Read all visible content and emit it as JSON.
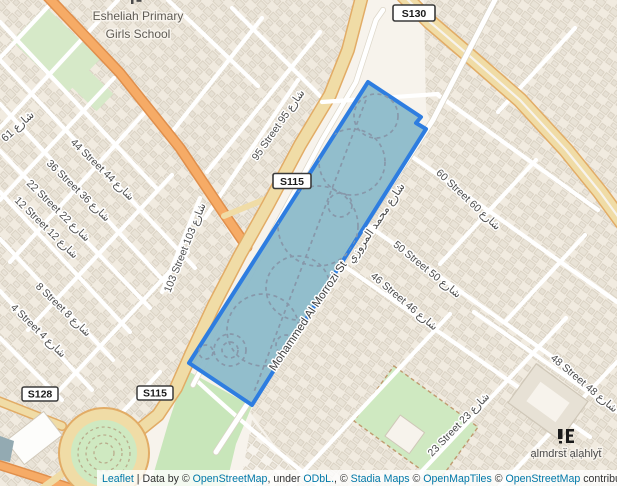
{
  "map": {
    "poi": {
      "school_line1": "Esheliah Primary",
      "school_line2": "Girls School",
      "mosque_school_label": "ạlmdrsẗ ạlạhlyẗ"
    },
    "shields": [
      {
        "text": "S130"
      },
      {
        "text": "S115"
      },
      {
        "text": "S115"
      },
      {
        "text": "S128"
      }
    ],
    "street_labels": [
      {
        "text": "44 Street 44 شارع"
      },
      {
        "text": "36 Street 36 شارع"
      },
      {
        "text": "22 Street 22 شارع"
      },
      {
        "text": "12 Street 12 شارع"
      },
      {
        "text": "8 Street 8 شارع"
      },
      {
        "text": "4 Street 4 شارع"
      },
      {
        "text": "شارع 61"
      },
      {
        "text": "103 Street 103 شارع"
      },
      {
        "text": "95 Street 95 شارع"
      },
      {
        "text": "60 Street 60 شارع"
      },
      {
        "text": "50 Street 50 شارع"
      },
      {
        "text": "46 Street 46 شارع"
      },
      {
        "text": "48 Street 48 شارع"
      },
      {
        "text": "23 Street 23 شارع"
      },
      {
        "text": "Mohammed Al Morrozi St"
      },
      {
        "text": "شارع محمد المروزي"
      }
    ],
    "selection": {
      "fill": "#8cbbca",
      "stroke": "#2e7de0",
      "path_color": "#8798aa"
    },
    "colors": {
      "background": "#f7f3ec",
      "highway_fill": "#f0dca6",
      "highway_casing": "#e2ac66",
      "primary_fill": "#f6ab66",
      "primary_casing": "#e08f4c",
      "park_green": "#c8e6ba",
      "link_blue": "#0078a8"
    }
  },
  "attribution": {
    "segments": [
      {
        "text": "Leaflet",
        "link": true
      },
      {
        "text": " | Data by © ",
        "link": false
      },
      {
        "text": "OpenStreetMap",
        "link": true
      },
      {
        "text": ", under ",
        "link": false
      },
      {
        "text": "ODbL.",
        "link": true
      },
      {
        "text": ", © ",
        "link": false
      },
      {
        "text": "Stadia Maps",
        "link": true
      },
      {
        "text": " © ",
        "link": false
      },
      {
        "text": "OpenMapTiles",
        "link": true
      },
      {
        "text": " © ",
        "link": false
      },
      {
        "text": "OpenStreetMap",
        "link": true
      },
      {
        "text": " contributors",
        "link": false
      }
    ]
  }
}
